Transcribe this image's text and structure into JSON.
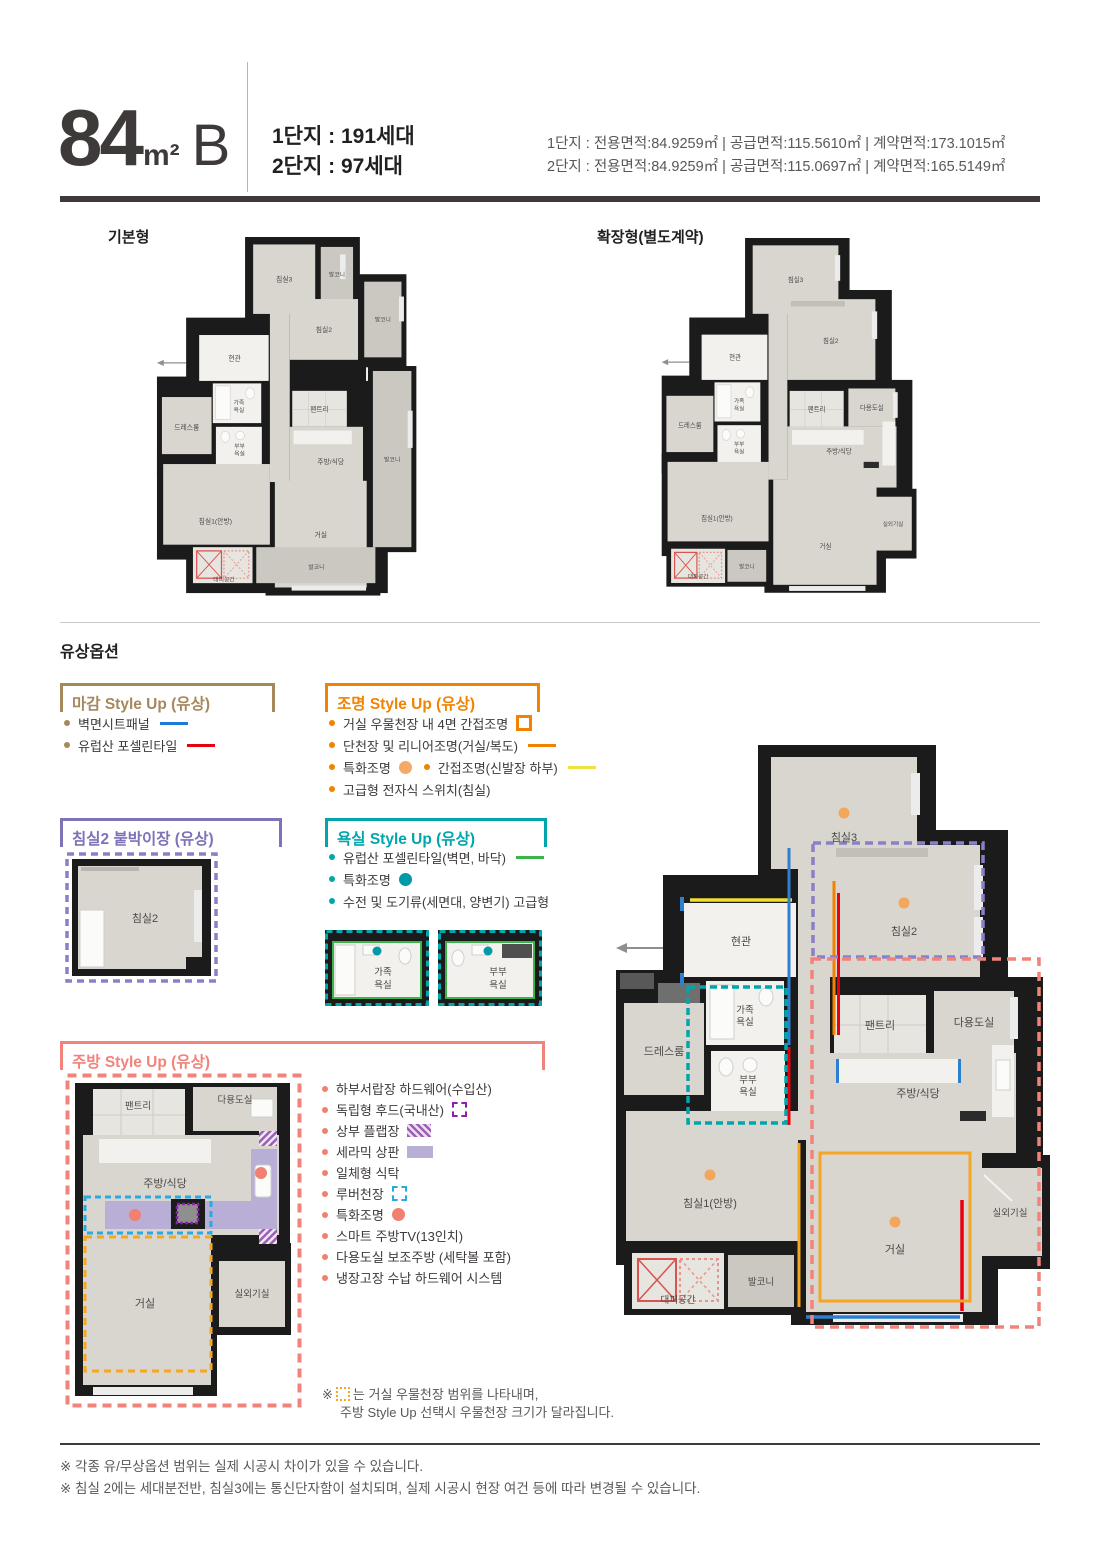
{
  "header": {
    "size": "84",
    "unit": "m²",
    "type": "B",
    "units_line1": "1단지 : 191세대",
    "units_line2": "2단지 : 97세대",
    "spec_line1": "1단지 : 전용면적:84.9259㎡ | 공급면적:115.5610㎡ | 계약면적:173.1015㎡",
    "spec_line2": "2단지 : 전용면적:84.9259㎡ | 공급면적:115.0697㎡ | 계약면적:165.5149㎡"
  },
  "plans": {
    "basic_label": "기본형",
    "extended_label": "확장형(별도계약)"
  },
  "section_title": "유상옵션",
  "rooms": {
    "bed3": "침실3",
    "bed2": "침실2",
    "bed1": "침실1(안방)",
    "living": "거실",
    "kitchen": "주방/식당",
    "entrance": "현관",
    "pantry": "팬트리",
    "utility": "다용도실",
    "dress": "드레스룸",
    "balcony": "발코니",
    "evac": "대피공간",
    "outdoor": "실외기실",
    "bath_family_1": "가족",
    "bath_family_2": "욕실",
    "bath_couple_1": "부부",
    "bath_couple_2": "욕실"
  },
  "options": {
    "finish": {
      "title": "마감 Style Up (유상)",
      "accent": "#a6885d",
      "items": [
        {
          "label": "벽면시트패널",
          "marker_color": "#1d7ad9"
        },
        {
          "label": "유럽산 포셀린타일",
          "marker_color": "#e60012"
        }
      ]
    },
    "lighting": {
      "title": "조명 Style Up (유상)",
      "accent": "#f08300",
      "item1": "거실 우물천장 내 4면 간접조명",
      "item2": "단천장 및 리니어조명(거실/복도)",
      "item3a": "특화조명",
      "item3b": "간접조명(신발장 하부)",
      "item4": "고급형 전자식 스위치(침실)",
      "colors": {
        "square": "#f08300",
        "line": "#f08300",
        "dot": "#f3a968",
        "yellow": "#f0e13c"
      }
    },
    "closet": {
      "title": "침실2 붙박이장 (유상)",
      "accent": "#7c73b8"
    },
    "bath": {
      "title": "욕실 Style Up (유상)",
      "accent": "#00a6ab",
      "item1": "유럽산 포셀린타일(벽면, 바닥)",
      "item2": "특화조명",
      "item3": "수전 및 도기류(세면대, 양변기) 고급형",
      "colors": {
        "green": "#3cb44a",
        "dot": "#0099a8"
      }
    },
    "kitchen": {
      "title": "주방 Style Up (유상)",
      "accent": "#f2837b",
      "items": [
        "하부서랍장 하드웨어(수입산)",
        "독립형 후드(국내산)",
        "상부 플랩장",
        "세라믹 상판",
        "일체형 식탁",
        "루버천장",
        "특화조명",
        "스마트 주방TV(13인치)",
        "다용도실 보조주방 (세탁볼 포함)",
        "냉장고장 수납 하드웨어 시스템"
      ],
      "colors": {
        "hood": "#8a1fa8",
        "flap": "#9d5fb5",
        "counter": "#b9aed6",
        "louver": "#29abe2",
        "dot": "#f08070"
      },
      "note_mark": "※",
      "note1": "는 거실 우물천장 범위를 나타내며,",
      "note2": "주방 Style Up 선택시 우물천장 크기가 달라집니다."
    }
  },
  "footnotes": [
    "※ 각종 유/무상옵션 범위는 실제 시공시 차이가 있을 수 있습니다.",
    "※ 침실 2에는 세대분전반, 침실3에는 통신단자함이 설치되며, 실제 시공시 현장 여건 등에 따라 변경될 수 있습니다."
  ],
  "palette": {
    "header_bar": "#3e3a39",
    "wall": "#1b1b1b",
    "floor": "#d9d6cf",
    "blue_line": "#2f7fd0",
    "red_line": "#e60012",
    "yellow_line": "#f3df2e",
    "orange_ceiling": "#f5a623",
    "dot_orange": "#f2a75b",
    "pink_box": "#f2837b",
    "purple_box": "#8b80c8",
    "teal_box": "#00a6ab"
  }
}
